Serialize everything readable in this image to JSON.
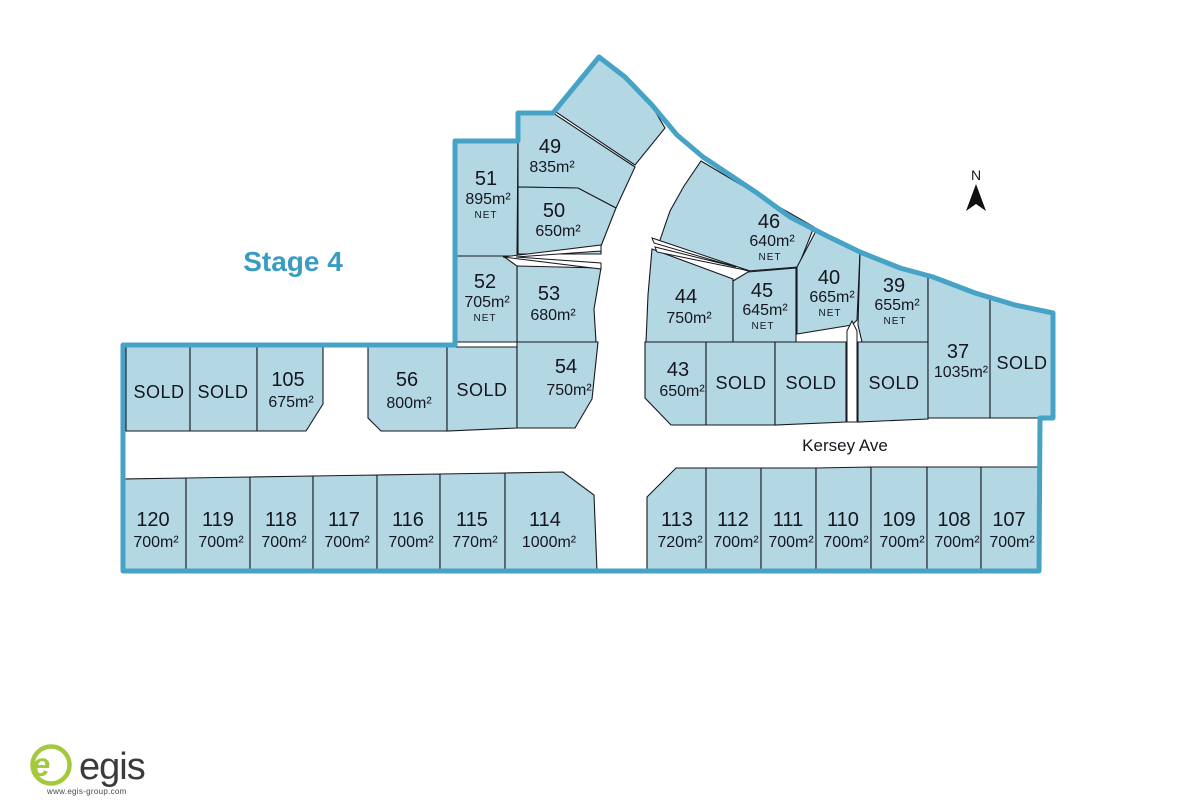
{
  "title": "Stage 4",
  "street": {
    "name": "Kersey Ave"
  },
  "north": {
    "label": "N"
  },
  "logo": {
    "mark": "e",
    "brand": "egis",
    "url": "www.egis-group.com"
  },
  "colors": {
    "lot_fill": "#b3d8e4",
    "boundary": "#47a3c6",
    "accent_text": "#3a9cc1",
    "lot_text": "#16161f",
    "logo_green": "#a3c93c"
  },
  "lots": {
    "l49": {
      "num": "49",
      "area": "835m²"
    },
    "l50": {
      "num": "50",
      "area": "650m²"
    },
    "l51": {
      "num": "51",
      "area": "895m²",
      "net": "NET"
    },
    "l52": {
      "num": "52",
      "area": "705m²",
      "net": "NET"
    },
    "l53": {
      "num": "53",
      "area": "680m²"
    },
    "l54": {
      "num": "54",
      "area": "750m²"
    },
    "l56": {
      "num": "56",
      "area": "800m²"
    },
    "l105": {
      "num": "105",
      "area": "675m²"
    },
    "l46": {
      "num": "46",
      "area": "640m²",
      "net": "NET"
    },
    "l44": {
      "num": "44",
      "area": "750m²"
    },
    "l45": {
      "num": "45",
      "area": "645m²",
      "net": "NET"
    },
    "l40": {
      "num": "40",
      "area": "665m²",
      "net": "NET"
    },
    "l39": {
      "num": "39",
      "area": "655m²",
      "net": "NET"
    },
    "l43": {
      "num": "43",
      "area": "650m²"
    },
    "l37": {
      "num": "37",
      "area": "1035m²"
    },
    "s1": {
      "label": "SOLD"
    },
    "s2": {
      "label": "SOLD"
    },
    "s3": {
      "label": "SOLD"
    },
    "s4": {
      "label": "SOLD"
    },
    "s5": {
      "label": "SOLD"
    },
    "s6": {
      "label": "SOLD"
    },
    "s7": {
      "label": "SOLD"
    },
    "l120": {
      "num": "120",
      "area": "700m²"
    },
    "l119": {
      "num": "119",
      "area": "700m²"
    },
    "l118": {
      "num": "118",
      "area": "700m²"
    },
    "l117": {
      "num": "117",
      "area": "700m²"
    },
    "l116": {
      "num": "116",
      "area": "700m²"
    },
    "l115": {
      "num": "115",
      "area": "770m²"
    },
    "l114": {
      "num": "114",
      "area": "1000m²"
    },
    "l113": {
      "num": "113",
      "area": "720m²"
    },
    "l112": {
      "num": "112",
      "area": "700m²"
    },
    "l111": {
      "num": "111",
      "area": "700m²"
    },
    "l110": {
      "num": "110",
      "area": "700m²"
    },
    "l109": {
      "num": "109",
      "area": "700m²"
    },
    "l108": {
      "num": "108",
      "area": "700m²"
    },
    "l107": {
      "num": "107",
      "area": "700m²"
    }
  }
}
